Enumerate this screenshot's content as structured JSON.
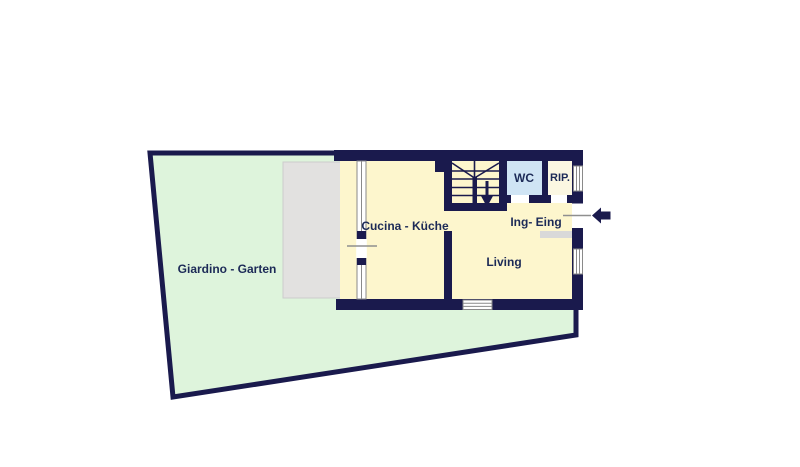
{
  "colors": {
    "wall": "#1a1a4d",
    "room": "#fdf6cd",
    "garden": "#def4dc",
    "terrace": "#e2e1e0",
    "wc": "#cfe4f4",
    "rip": "#fbf7e2",
    "step": "#d9d9d9",
    "winframe": "#8a8a8a",
    "marker": "#8f8f8f",
    "label": "#1c2a57"
  },
  "rooms": {
    "garden": {
      "label": "Giardino - Garten"
    },
    "kitchen": {
      "label": "Cucina - Küche"
    },
    "living": {
      "label": "Living"
    },
    "wc": {
      "label": "WC"
    },
    "storage": {
      "label": "RIP."
    },
    "entrance": {
      "label": "Ing- Eing"
    }
  }
}
